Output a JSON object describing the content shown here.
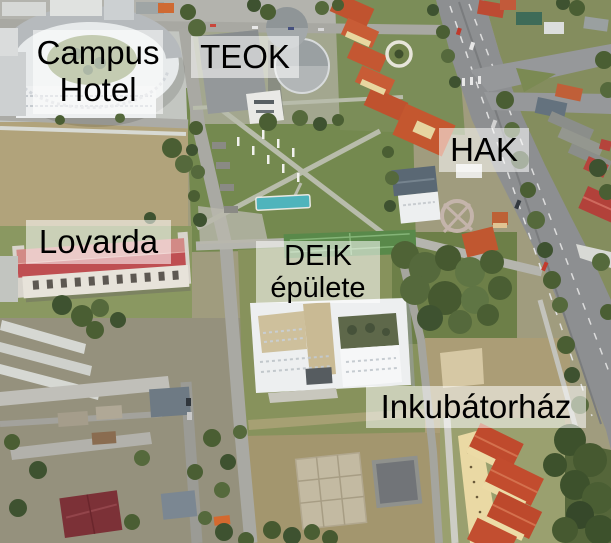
{
  "map": {
    "labels": [
      {
        "id": "campus-hotel",
        "text": "Campus\nHotel"
      },
      {
        "id": "teok",
        "text": "TEOK"
      },
      {
        "id": "hak",
        "text": "HAK"
      },
      {
        "id": "lovarda",
        "text": "Lovarda"
      },
      {
        "id": "deik-epulete",
        "text": "DEIK\népülete"
      },
      {
        "id": "inkubatorhaz",
        "text": "Inkubátorház"
      }
    ],
    "label_style": {
      "text_color": "#000000",
      "background_color": "#FFFFFF",
      "background_opacity": 0.55
    }
  }
}
